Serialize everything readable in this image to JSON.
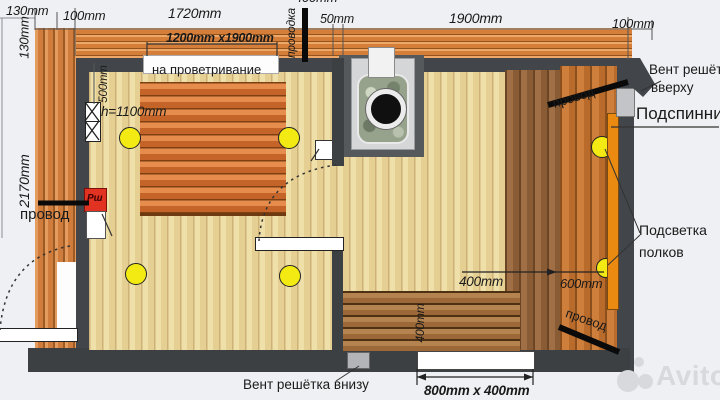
{
  "plan_title": "sauna-floor-plan",
  "colors": {
    "wall": "#42464a",
    "wood_clad": "#d57e3a",
    "floor": "#efdfa9",
    "bench_orange": "#e68d4e",
    "light_yellow": "#f2ea12",
    "backrest_strip": "#ea8a10",
    "shield_red": "#e23222",
    "watermark_gray": "#d7d9dc"
  },
  "top_dims": {
    "d130_h": "130mm",
    "d130_v": "130mm",
    "d100_left": "100mm",
    "d1720": "1720mm",
    "bench_size": "1200mm  x1900mm",
    "vent_note": "на проветривание",
    "wiring_vertical": "проводка",
    "d50": "50mm",
    "d1900": "1900mm",
    "d100_right": "100mm",
    "clipped_dim": "400mm"
  },
  "left_side": {
    "d2170": "2170mm",
    "wire": "провод",
    "d500": "500mm",
    "bench_height": "h=1100mm",
    "shield": "Рш"
  },
  "right_side": {
    "vent_top_line1": "Вент решётка",
    "vent_top_line2": "вверху",
    "backrest": "Подспинник",
    "lighting_line1": "Подсветка",
    "lighting_line2": "полков",
    "wire_top": "провод",
    "wire_bottom": "провод",
    "d400": "400mm",
    "d600": "600mm"
  },
  "bottom_side": {
    "d400_rotated": "400mm",
    "window_size": "800mm  x 400mm",
    "vent_bottom": "Вент решётка внизу"
  },
  "watermark": {
    "brand": "Avito"
  }
}
